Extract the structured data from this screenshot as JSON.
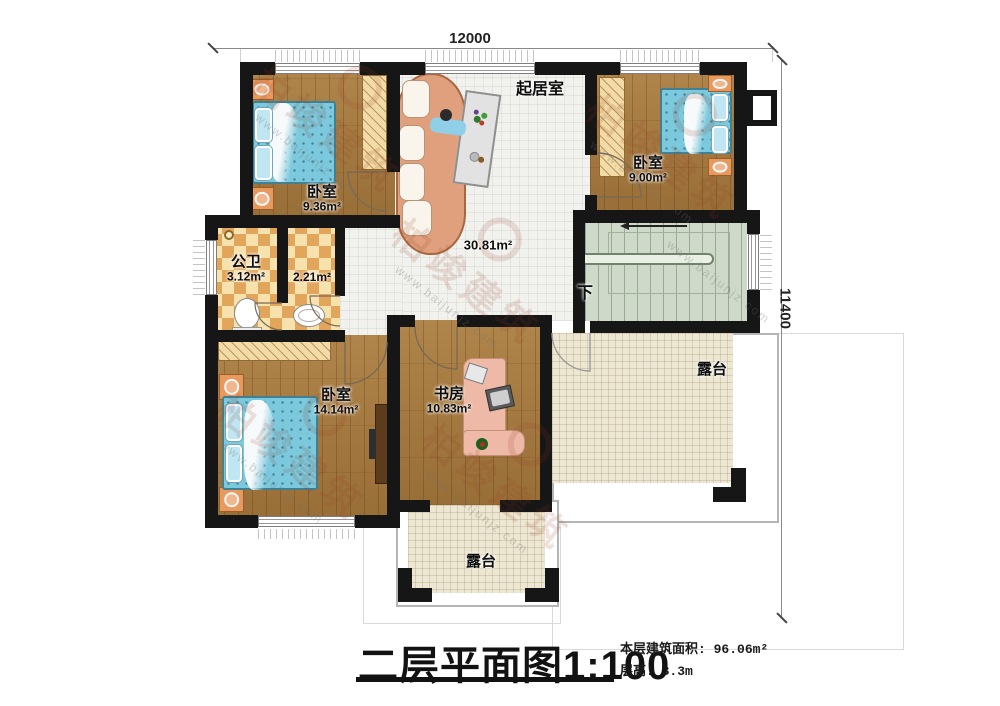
{
  "dimensions": {
    "top": "12000",
    "right": "11400"
  },
  "rooms": {
    "bedroom_tl": {
      "name": "卧室",
      "area": "9.36m²"
    },
    "bedroom_tr": {
      "name": "卧室",
      "area": "9.00m²"
    },
    "bedroom_bl": {
      "name": "卧室",
      "area": "14.14m²"
    },
    "bathroom": {
      "name": "公卫",
      "area": "3.12m²"
    },
    "closet": {
      "area": "2.21m²"
    },
    "living": {
      "name": "起居室",
      "area": "30.81m²"
    },
    "study": {
      "name": "书房",
      "area": "10.83m²"
    },
    "stairs": {
      "label": "下"
    },
    "terrace_right": {
      "name": "露台"
    },
    "terrace_bottom": {
      "name": "露台"
    }
  },
  "titleblock": {
    "title": "二层平面图",
    "scale": "1:100",
    "floor_area_label": "本层建筑面积: ",
    "floor_area": "96.06m²",
    "floor_height_label": "层高: ",
    "floor_height": "3.3m"
  },
  "watermark": {
    "brand": "柏竣建筑",
    "url": "www.baijunjz.com"
  }
}
